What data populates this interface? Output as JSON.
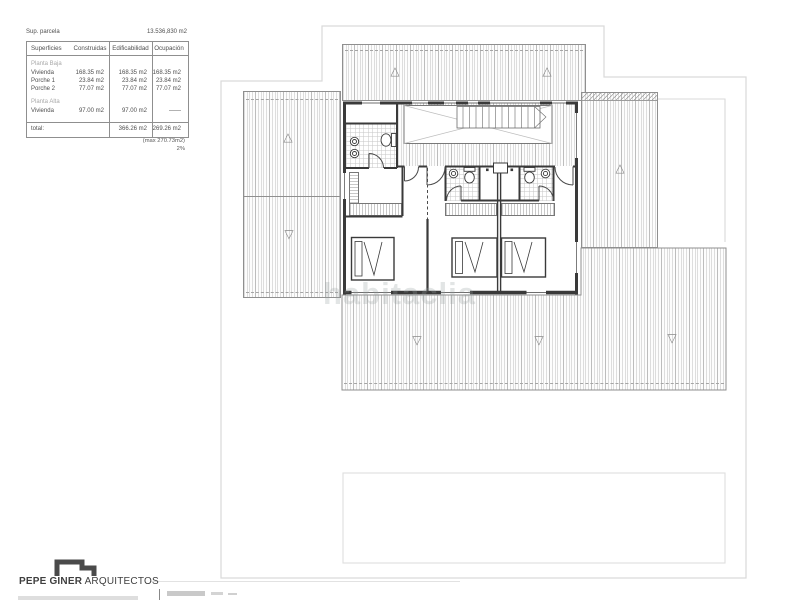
{
  "document": {
    "parcel_label": "Sup. parcela",
    "parcel_value": "13.536,830 m2"
  },
  "surfaces_table": {
    "col_headers": [
      "Superficies",
      "Construidas",
      "Edificabilidad",
      "Ocupación"
    ],
    "section_1_title": "Planta Baja",
    "section_2_title": "Planta Alta",
    "rows_pb": [
      {
        "label": "Vivienda",
        "construidas": "168.35 m2",
        "edificabilidad": "168.35 m2",
        "ocupacion": "168.35 m2"
      },
      {
        "label": "Porche 1",
        "construidas": "23.84 m2",
        "edificabilidad": "23.84 m2",
        "ocupacion": "23.84 m2"
      },
      {
        "label": "Porche 2",
        "construidas": "77.07 m2",
        "edificabilidad": "77.07 m2",
        "ocupacion": "77.07 m2"
      }
    ],
    "rows_pa": [
      {
        "label": "Vivienda",
        "construidas": "97.00 m2",
        "edificabilidad": "97.00 m2",
        "ocupacion": "——"
      }
    ],
    "total_row": {
      "label": "total:",
      "construidas": "",
      "edificabilidad": "366.26 m2",
      "ocupacion": "269.26 m2"
    },
    "footnote1": "(max 270.73m2)",
    "footnote2": "2%"
  },
  "plan": {
    "watermark": "habitaclia",
    "up_arrow": "△",
    "down_arrow": "▽"
  },
  "footer": {
    "brand_name": "PEPE GINER",
    "brand_suffix": " ARQUITECTOS"
  },
  "colors": {
    "wall": "#3a3a3a",
    "hatch_line": "#9a9a9a",
    "boundary": "#d9d9d9",
    "table_line": "#8f8f8f",
    "muted_label": "#a9a9a9"
  }
}
